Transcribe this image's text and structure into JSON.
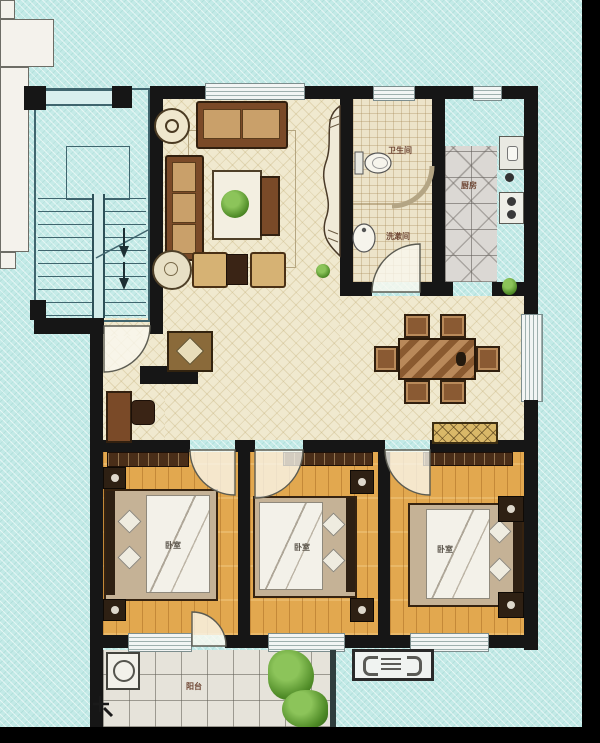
{
  "meta": {
    "type": "apartment-floor-plan-photo",
    "style": "three-bedroom unit with stairwell, rendered plan on cyan textured background"
  },
  "colors": {
    "background": "#c3eae7",
    "wall": "#161616",
    "living_floor": "#f0e9cf",
    "bedroom_wood": "#e2a84f",
    "bathroom_plaid": "#ece3c9",
    "kitchen_tile": "#dbd8d4",
    "balcony_tile": "#e6e3da",
    "label_text": "#6e4633",
    "plant_green": "#4e8a26",
    "frame_black_edges": "#000000"
  },
  "rooms": {
    "bathroom": {
      "label": "卫生间"
    },
    "washroom": {
      "label": "洗漱间"
    },
    "kitchen": {
      "label": "厨房"
    },
    "bedrooms": [
      {
        "label": "卧室"
      },
      {
        "label": "卧室"
      },
      {
        "label": "卧室"
      }
    ],
    "balcony": {
      "label": "阳台"
    },
    "living": {
      "label": ""
    },
    "dining": {
      "label": ""
    }
  },
  "fixtures": [
    "stairwell-with-arrows",
    "entry-door-swing",
    "entry-rug",
    "sofa-set",
    "coffee-table-with-plant",
    "tv-cabinet-wave",
    "toilet",
    "shower-arc",
    "wash-basin",
    "fridge",
    "kitchen-counter-sink-stove",
    "dining-table-six-chairs",
    "sideboard",
    "three-beds-with-nightstands",
    "washing-machine",
    "water-tap",
    "balcony-plant",
    "ac-outdoor-unit"
  ]
}
